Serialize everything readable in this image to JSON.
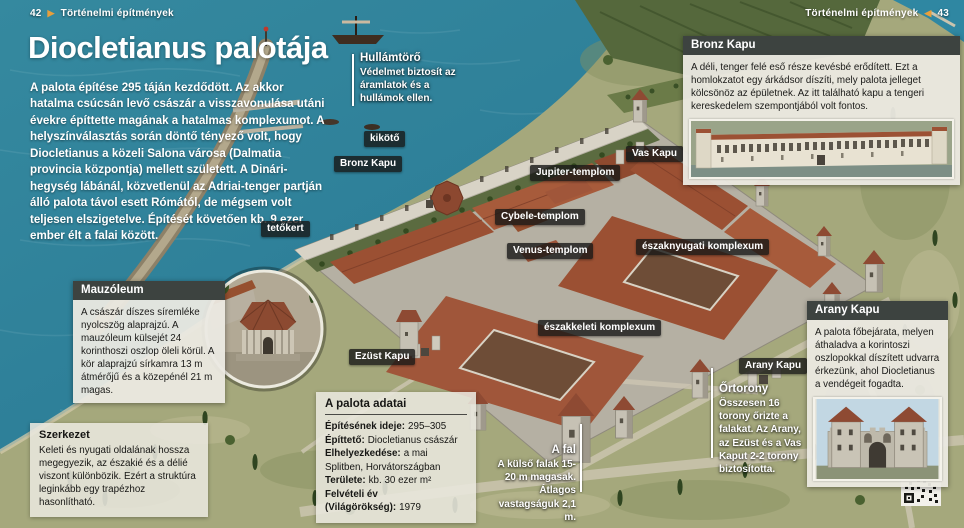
{
  "header": {
    "left": {
      "page": "42",
      "arrow": "▶",
      "section": "Történelmi építmények"
    },
    "right": {
      "section": "Történelmi építmények",
      "arrow": "◀",
      "page": "43"
    }
  },
  "title": "Diocletianus palotája",
  "intro": "A palota építése 295 táján kezdődött. Az akkor hatalma csúcsán levő császár a visszavonulása utáni évekre építtette magának a hatalmas komplexumot. A helyszínválasztás során döntő tényező volt, hogy Diocletianus a közeli Salona városa (Dalmatia provincia központja) mellett született. A Dinári-hegység lábánál, közvetlenül az Adriai-tenger partján álló palota távol esett Rómától, de mégsem volt teljesen elszigetelve. Építését követően kb. 9 ezer ember élt a falai között.",
  "map_labels": [
    {
      "text": "kikötő"
    },
    {
      "text": "Bronz Kapu"
    },
    {
      "text": "tetőkert"
    },
    {
      "text": "Vas Kapu"
    },
    {
      "text": "Jupiter-templom"
    },
    {
      "text": "Cybele-templom"
    },
    {
      "text": "Venus-templom"
    },
    {
      "text": "északnyugati komplexum"
    },
    {
      "text": "északkeleti komplexum"
    },
    {
      "text": "Ezüst Kapu"
    },
    {
      "text": "Arany Kapu"
    }
  ],
  "callouts": {
    "hullamtoro": {
      "title": "Hullámtörő",
      "body": "Védelmet biztosít az áramlatok és a hullámok ellen."
    },
    "fal": {
      "title": "A fal",
      "body": "A külső falak 15-20 m magasak. Átlagos vastagságuk 2,1 m."
    },
    "ortorony": {
      "title": "Őrtorony",
      "body": "Összesen 16 torony őrizte a falakat. Az Arany, az Ezüst és a Vas Kaput 2-2 torony biztosította."
    }
  },
  "boxes": {
    "mauzoleum": {
      "title": "Mauzóleum",
      "body": "A császár díszes síremléke nyolcszög alaprajzú. A mauzóleum külsejét 24 korinthoszi oszlop öleli körül. A kör alaprajzú sírkamra 13 m átmérőjű és a közepénél 21 m magas."
    },
    "szerkezet": {
      "title": "Szerkezet",
      "body": "Keleti és nyugati oldalának hossza megegyezik, az északié és a délié viszont különbözik. Ezért a struktúra leginkább egy trapézhoz hasonlítható."
    },
    "adatok": {
      "title": "A palota adatai",
      "rows": [
        {
          "label": "Építésének ideje:",
          "value": "295–305"
        },
        {
          "label": "Építtető:",
          "value": "Diocletianus császár"
        },
        {
          "label": "Elhelyezkedése:",
          "value": "a mai Splitben, Horvátországban"
        },
        {
          "label": "Területe:",
          "value": "kb. 30 ezer m²"
        },
        {
          "label": "Felvételi év (Világörökség):",
          "value": "1979"
        }
      ]
    },
    "bronz": {
      "title": "Bronz Kapu",
      "body": "A déli, tenger felé eső része kevésbé erődített. Ezt a homlokzatot egy árkádsor díszíti, mely palota jelleget kölcsönöz az épületnek. Az itt található kapu a tengeri kereskedelem szempontjából volt fontos."
    },
    "arany": {
      "title": "Arany Kapu",
      "body": "A palota főbejárata, melyen áthaladva a korintoszi oszlopokkal díszített udvarra érkezünk, ahol Diocletianus a vendégeit fogadta."
    }
  },
  "colors": {
    "ocean": "#2e7f99",
    "land": "#a5a87c",
    "roof": "#9b5033",
    "stone": "#c6c1b4",
    "box_header": "#3d4340",
    "accent_arrow": "#e79f3c"
  }
}
